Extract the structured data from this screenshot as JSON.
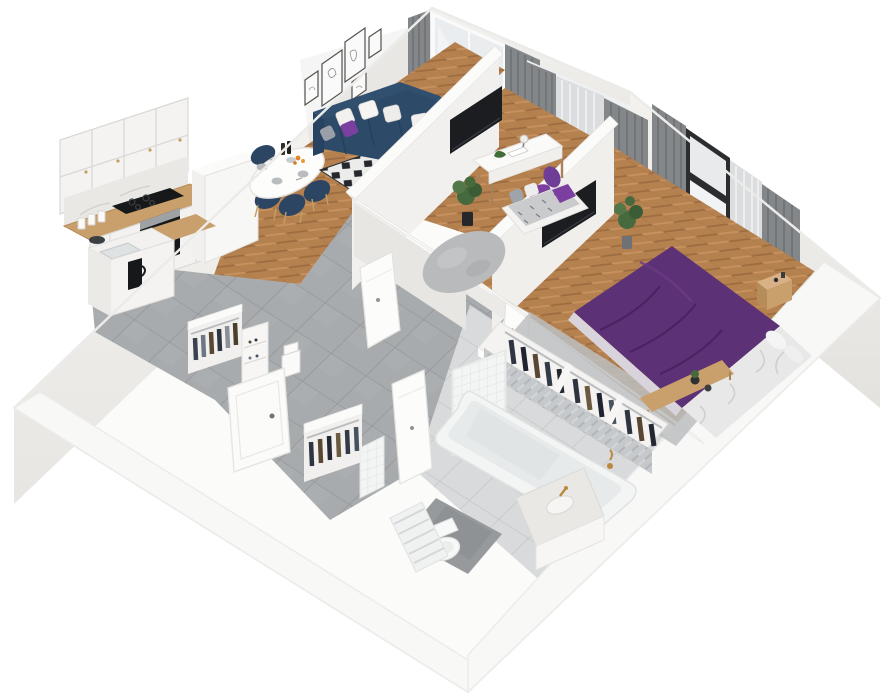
{
  "scene": {
    "description": "3D isometric cutaway (dollhouse) render of a one-bedroom apartment floor plan",
    "view": "axonometric top-down, walls cut, no people, no text",
    "background": "#ffffff"
  },
  "palette": {
    "wall": "#f7f6f4",
    "wall_face": "#eceae6",
    "wall_shadow": "#dddbd7",
    "floor_wood": "#b5814f",
    "floor_wood_dark": "#9e6c41",
    "floor_wood_light": "#c8925f",
    "tile_hall": "#a8abad",
    "tile_hall_line": "#94979a",
    "tile_bath": "#d8dadb",
    "tile_bath_line": "#c3c6c7",
    "sofa_navy": "#2d4a69",
    "sofa_navy_dark": "#24405d",
    "chair_navy": "#2b4563",
    "accent_purple": "#7b3fa0",
    "bed_purple": "#5c3175",
    "bed_purple_dark": "#472460",
    "curtain_gray": "#84878a",
    "curtain_sheer": "#dbdddf",
    "window_frame_dark": "#2c2d2f",
    "tv_black": "#1b1d21",
    "plant_green": "#466a3e",
    "plant_green_light": "#5d8252",
    "counter_wood": "#c9a06b",
    "marble": "#eae8e4",
    "gold": "#b98a3e",
    "rug_gray": "#b9babb",
    "rug_diamond": "#24272b",
    "appliance_black": "#17181a",
    "clothes_navy": "#2e3440",
    "clothes_brown": "#5a4733",
    "white_furniture": "#f4f3f1"
  },
  "rooms": [
    {
      "id": "living-dining",
      "label": "Living / Dining",
      "furniture": [
        "navy corner sofa",
        "white & purple cushions",
        "round coffee table",
        "purple vase",
        "black & white diamond rug",
        "oval dining table",
        "4 navy dining chairs",
        "tableware & flowers",
        "5 wall art frames",
        "balcony glass door",
        "gray curtains"
      ]
    },
    {
      "id": "kitchen",
      "label": "Kitchen",
      "furniture": [
        "white upper cabinets",
        "marble backsplash",
        "wood countertop",
        "induction hob",
        "built-in oven",
        "sink peninsula",
        "french press",
        "tall fridge cabinet",
        "canisters"
      ]
    },
    {
      "id": "office",
      "label": "Office",
      "furniture": [
        "white desk",
        "desk lamp",
        "toy dinosaur",
        "open book",
        "purple swivel chair",
        "daybed with cushions",
        "potted plant",
        "round gray rug",
        "wall TV",
        "window with gray curtains"
      ]
    },
    {
      "id": "bedroom",
      "label": "Bedroom",
      "furniture": [
        "double bed purple bedding",
        "white sheets",
        "foot bench with plants",
        "wood nightstand",
        "radiator",
        "open wardrobe with dark clothes",
        "wall TV",
        "black framed window",
        "gray curtains",
        "potted plant"
      ]
    },
    {
      "id": "bathroom",
      "label": "Bathroom",
      "furniture": [
        "bathtub",
        "gold tub faucet",
        "marble vanity with gold tap",
        "toilet",
        "towel ladder",
        "herringbone tiled wall",
        "square tiled wall",
        "dark floor mat"
      ]
    },
    {
      "id": "hallway-entry",
      "label": "Hallway / Entry",
      "furniture": [
        "entry door",
        "open wardrobe with clothes",
        "shoe cabinet",
        "storage boxes",
        "second open wardrobe",
        "ajar interior doors",
        "gray tiled floor"
      ]
    }
  ]
}
